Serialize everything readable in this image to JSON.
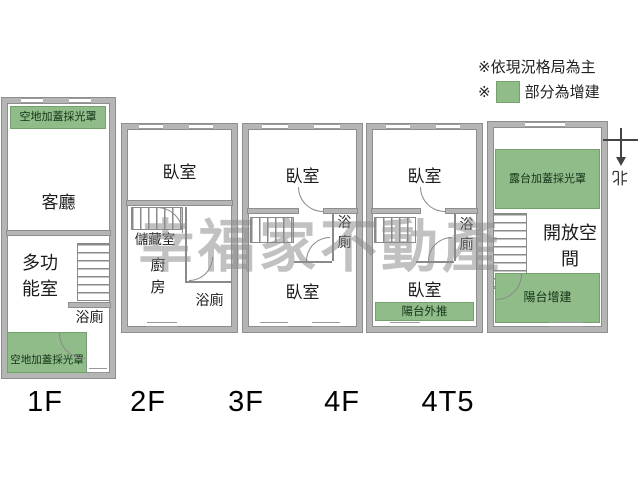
{
  "legend": {
    "note1": "※依現況格局為主",
    "note2_prefix": "※",
    "note2_text": "部分為增建"
  },
  "watermark": "幸福家不動產",
  "compass": {
    "label": "北"
  },
  "colors": {
    "addition_green": "#8fbc88",
    "wall_gray": "#b5b5b5"
  },
  "floors": [
    {
      "label": "1F",
      "rooms": {
        "canopy_top": "空地加蓋採光罩",
        "living": "客廳",
        "multi": "多功能室",
        "bath": "浴廁",
        "canopy_bottom": "空地加蓋採光罩"
      }
    },
    {
      "label": "2F",
      "rooms": {
        "bedroom": "臥室",
        "storage": "儲藏室",
        "kitchen": "廚房",
        "bath": "浴廁"
      }
    },
    {
      "label": "3F",
      "rooms": {
        "bedroom_top": "臥室",
        "bath": "浴廁",
        "bedroom_bottom": "臥室"
      }
    },
    {
      "label": "4F",
      "rooms": {
        "bedroom_top": "臥室",
        "bath": "浴廁",
        "bedroom_bottom": "臥室",
        "balcony": "陽台外推"
      }
    },
    {
      "label": "4T5",
      "rooms": {
        "terrace": "露台加蓋採光罩",
        "open_space": "開放空間",
        "balcony": "陽台增建"
      }
    }
  ]
}
